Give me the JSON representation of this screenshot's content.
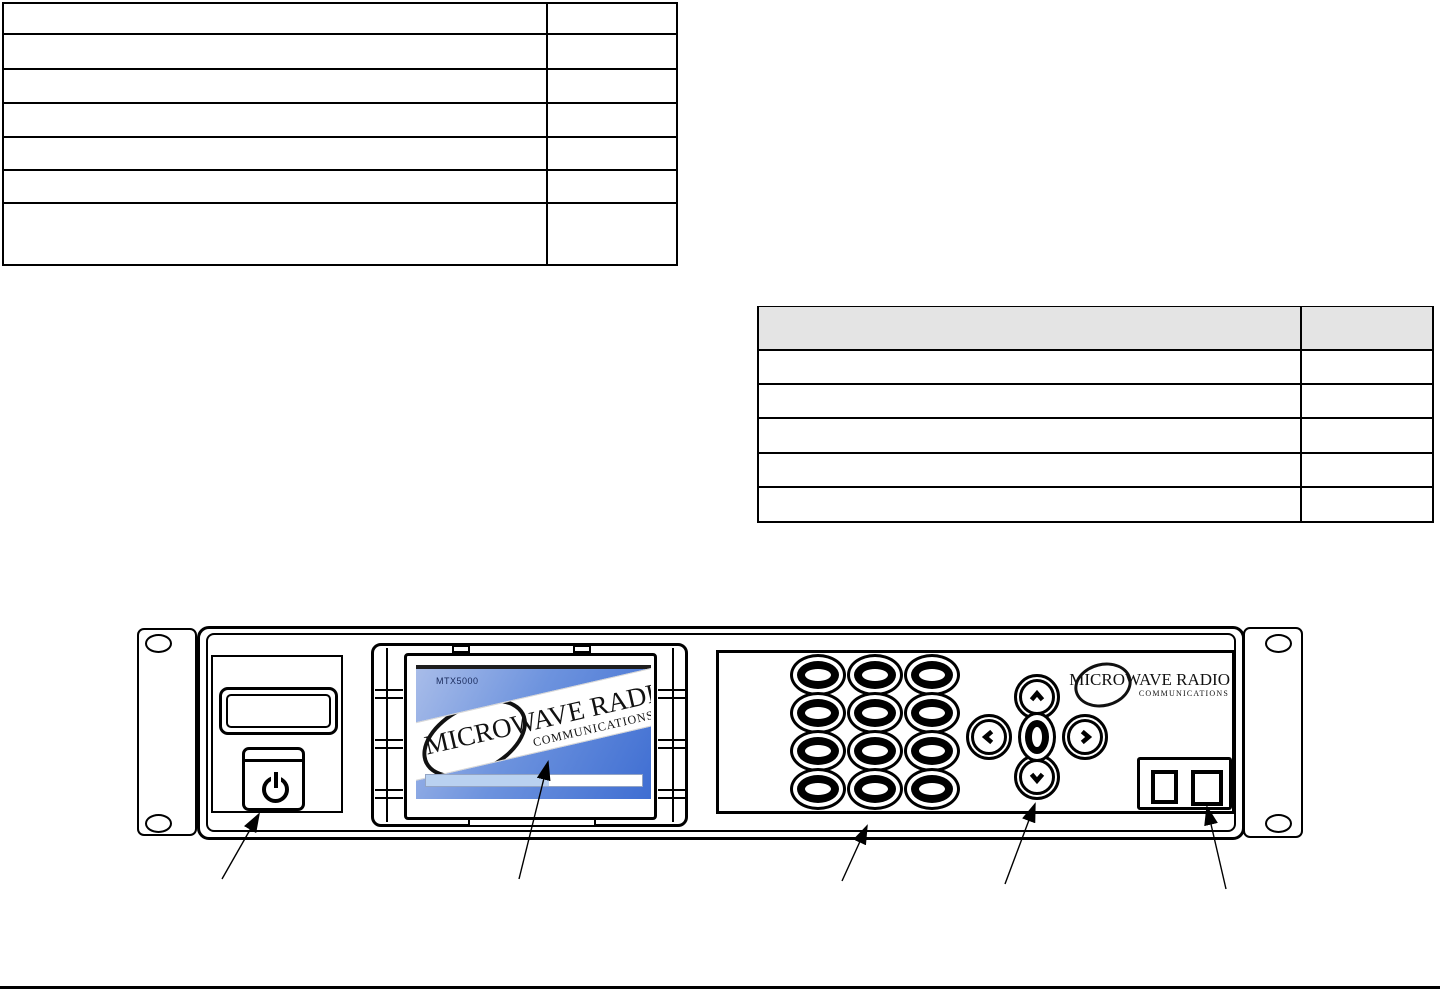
{
  "left_table": {
    "row_count": 7,
    "column_count": 2,
    "rows": [
      [
        "",
        ""
      ],
      [
        "",
        ""
      ],
      [
        "",
        ""
      ],
      [
        "",
        ""
      ],
      [
        "",
        ""
      ],
      [
        "",
        ""
      ],
      [
        "",
        ""
      ]
    ]
  },
  "right_table": {
    "has_header": true,
    "header": [
      "",
      ""
    ],
    "header_bg": "#e4e4e4",
    "row_count": 5,
    "column_count": 2,
    "rows": [
      [
        "",
        ""
      ],
      [
        "",
        ""
      ],
      [
        "",
        ""
      ],
      [
        "",
        ""
      ],
      [
        "",
        ""
      ]
    ]
  },
  "device": {
    "screen": {
      "model_label": "MTX5000",
      "logo_line1": "MICROWAVE RADIO",
      "logo_line2": "COMMUNICATIONS",
      "progress_percent": 57,
      "screen_color_top": "#a9bde9",
      "screen_color_bottom": "#3f6ed2",
      "progress_fill_color": "#b9d1f0"
    },
    "panel_logo": {
      "line1": "MICROWAVE RADIO",
      "line2": "COMMUNICATIONS"
    },
    "keypad": {
      "rows": 4,
      "columns": 3,
      "button_count": 12
    },
    "nav_buttons": [
      "up",
      "left",
      "center",
      "right",
      "down"
    ],
    "power_button": {
      "icon": "power-icon"
    },
    "connector": {
      "ports": 2
    },
    "callouts": {
      "count": 5,
      "targets": [
        "power-button",
        "display-screen",
        "keypad",
        "nav-buttons",
        "connector"
      ]
    }
  }
}
